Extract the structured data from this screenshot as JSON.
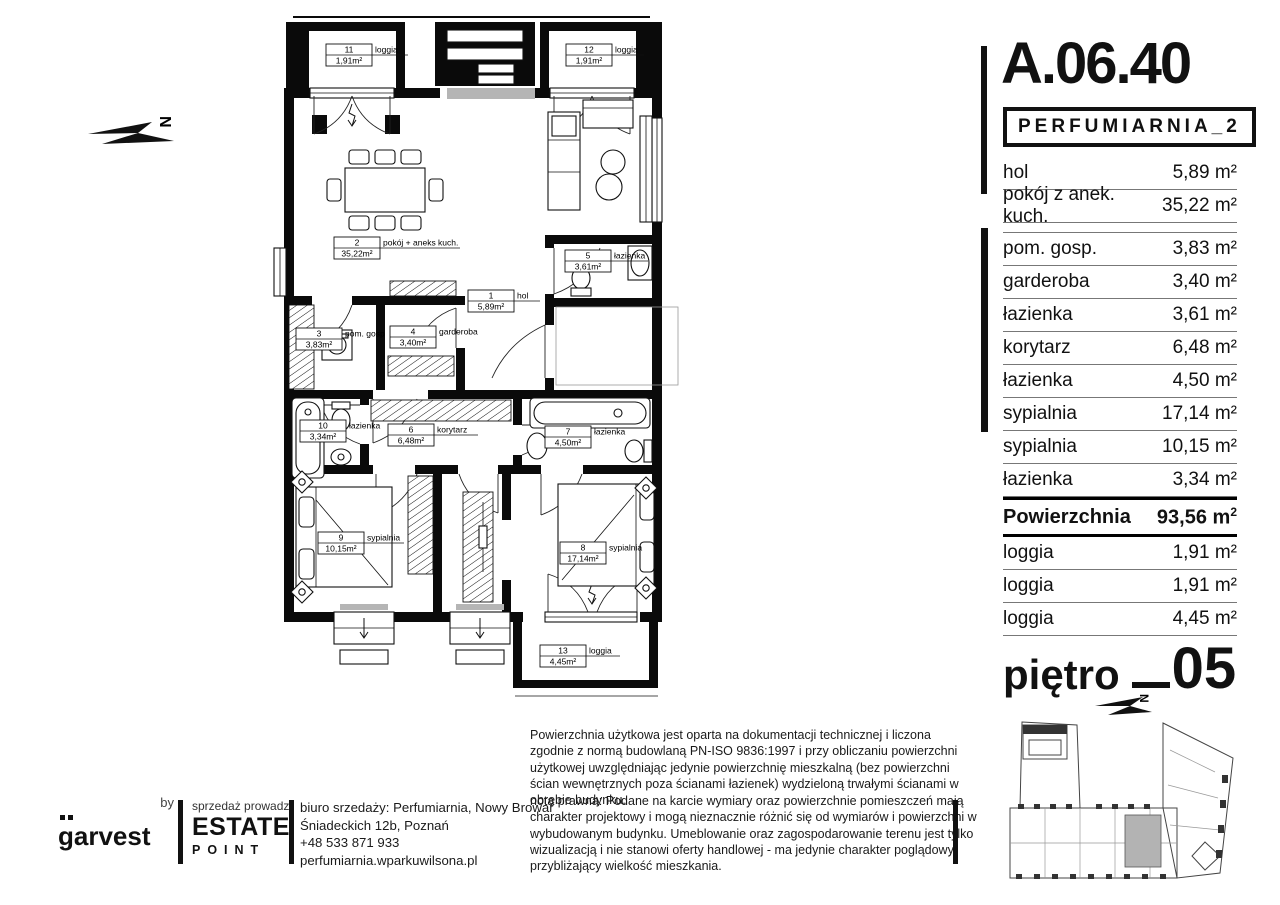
{
  "panel": {
    "unit_id": "A.06.40",
    "project": "PERFUMIARNIA_2",
    "rows": [
      {
        "label": "hol",
        "value": "5,89 m²"
      },
      {
        "label": "pokój z anek. kuch.",
        "value": "35,22 m²"
      },
      {
        "label": "pom. gosp.",
        "value": "3,83 m²"
      },
      {
        "label": "garderoba",
        "value": "3,40 m²"
      },
      {
        "label": "łazienka",
        "value": "3,61 m²"
      },
      {
        "label": "korytarz",
        "value": "6,48 m²"
      },
      {
        "label": "łazienka",
        "value": "4,50 m²"
      },
      {
        "label": "sypialnia",
        "value": "17,14 m²"
      },
      {
        "label": "sypialnia",
        "value": "10,15 m²"
      },
      {
        "label": "łazienka",
        "value": "3,34 m²"
      }
    ],
    "total": {
      "label": "Powierzchnia",
      "value": "93,56 m",
      "sup": "2"
    },
    "loggias": [
      {
        "label": "loggia",
        "value": "1,91 m²"
      },
      {
        "label": "loggia",
        "value": "1,91 m²"
      },
      {
        "label": "loggia",
        "value": "4,45 m²"
      }
    ],
    "floor": {
      "label": "piętro",
      "number": "05"
    }
  },
  "plan": {
    "north_letter": "N",
    "rooms": {
      "r1": {
        "num": "1",
        "name": "hol",
        "area": "5,89m²"
      },
      "r2": {
        "num": "2",
        "name": "pokój + aneks kuch.",
        "area": "35,22m²"
      },
      "r3": {
        "num": "3",
        "name": "pom. gosp",
        "area": "3,83m²"
      },
      "r4": {
        "num": "4",
        "name": "garderoba",
        "area": "3,40m²"
      },
      "r5": {
        "num": "5",
        "name": "łazienka",
        "area": "3,61m²"
      },
      "r6": {
        "num": "6",
        "name": "korytarz",
        "area": "6,48m²"
      },
      "r7": {
        "num": "7",
        "name": "łazienka",
        "area": "4,50m²"
      },
      "r8": {
        "num": "8",
        "name": "sypialnia",
        "area": "17,14m²"
      },
      "r9": {
        "num": "9",
        "name": "sypialnia",
        "area": "10,15m²"
      },
      "r10": {
        "num": "10",
        "name": "łazienka",
        "area": "3,34m²"
      },
      "r11": {
        "num": "11",
        "name": "loggia",
        "area": "1,91m²"
      },
      "r12": {
        "num": "12",
        "name": "loggia",
        "area": "1,91m²"
      },
      "r13": {
        "num": "13",
        "name": "loggia",
        "area": "4,45m²"
      }
    }
  },
  "footer": {
    "area_note": "Powierzchnia użytkowa jest oparta na dokumentacji technicznej i liczona zgodnie z normą budowlaną PN-ISO 9836:1997 i przy obliczaniu powierzchni użytkowej uwzględniając jedynie powierzchnię mieszkalną (bez powierzchni ścian wewnętrznych poza ścianami łazienek) wydzieloną trwałymi ścianami w obrębie budynku.",
    "legal_note": "nota prawna: Podane na karcie wymiary oraz powierzchnie pomieszczeń mają charakter projektowy i mogą nieznacznie różnić się od wymiarów i powierzchni w wybudowanym budynku. Umeblowanie oraz zagospodarowanie terenu jest tylko wizualizacją i nie stanowi oferty handlowej - ma jedynie charakter poglądowy, przybliżający wielkość mieszkania.",
    "by_label": "by",
    "brand": "garvest",
    "sales_intro": "sprzedaż prowadzi",
    "agency_line1": "ESTATE",
    "agency_line2": "POINT",
    "office_lines": [
      "biuro srzedaży: Perfumiarnia, Nowy Browar",
      "Śniadeckich 12b, Poznań",
      "+48 533 871 933",
      "perfumiarnia.wparkuwilsona.pl"
    ]
  },
  "colors": {
    "accent": "#111111",
    "highlight": "#b3b3b3"
  }
}
